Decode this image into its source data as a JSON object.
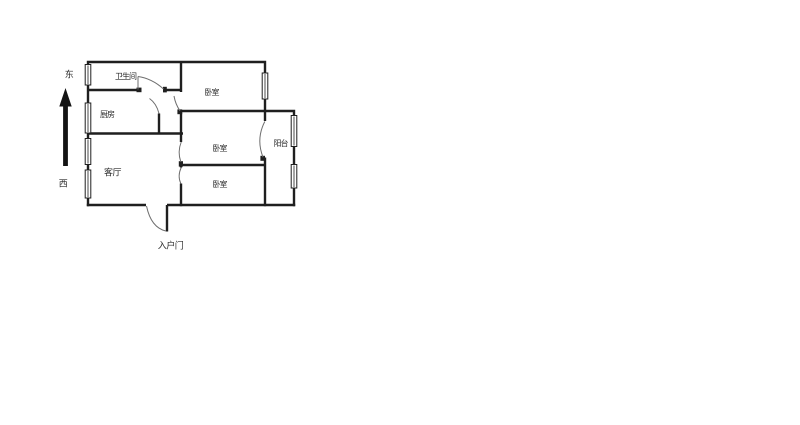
{
  "title": "房型平面图",
  "compass": {
    "east_label": "东",
    "west_label": "西"
  },
  "rooms": {
    "bathroom": {
      "label": "卫生间"
    },
    "kitchen": {
      "label": "厨房"
    },
    "living_room": {
      "label": "客厅"
    },
    "bedroom_north": {
      "label": "卧室"
    },
    "bedroom_middle": {
      "label": "卧室"
    },
    "bedroom_south": {
      "label": "卧室"
    },
    "balcony": {
      "label": "阳台"
    }
  },
  "entrance": {
    "label": "入户门"
  },
  "colors": {
    "wall": "#1f1f1f",
    "thin_line": "#6e6e6e",
    "label_text": "#2b2b2b",
    "background": "#ffffff"
  }
}
